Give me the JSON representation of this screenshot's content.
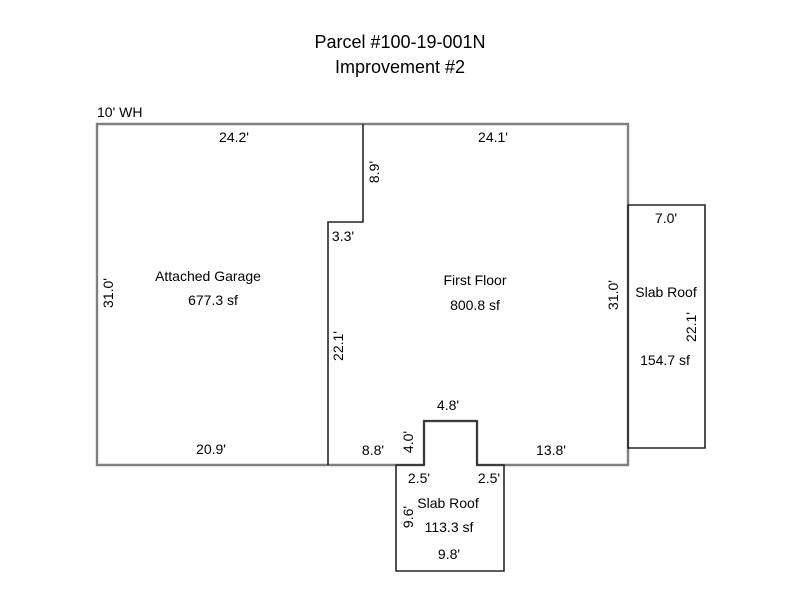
{
  "title": {
    "line1": "Parcel #100-19-001N",
    "line2": "Improvement #2"
  },
  "notes": {
    "wall_height": "10' WH"
  },
  "areas": {
    "attached_garage": {
      "label": "Attached Garage",
      "area": "677.3 sf",
      "dim_top": "24.2'",
      "dim_left": "31.0'",
      "dim_bottom": "20.9'"
    },
    "first_floor": {
      "label": "First Floor",
      "area": "800.8 sf",
      "dim_top": "24.1'",
      "dim_right": "31.0'",
      "dim_step_depth": "8.9'",
      "dim_step_width": "3.3'",
      "dim_divider_wall": "22.1'",
      "dim_bottom_left": "8.8'",
      "dim_bottom_right": "13.8'",
      "dim_notch_width": "4.8'",
      "dim_notch_depth": "4.0'"
    },
    "right_slab_roof": {
      "label": "Slab Roof",
      "area": "154.7 sf",
      "dim_top": "7.0'",
      "dim_side": "22.1'"
    },
    "bottom_slab_roof": {
      "label": "Slab Roof",
      "area": "113.3 sf",
      "dim_inset_left": "2.5'",
      "dim_inset_right": "2.5'",
      "dim_side": "9.6'",
      "dim_bottom": "9.8'"
    }
  },
  "colors": {
    "outline_outer": "#808080",
    "outline_detail": "#262626",
    "text": "#000000",
    "background": "#ffffff"
  }
}
